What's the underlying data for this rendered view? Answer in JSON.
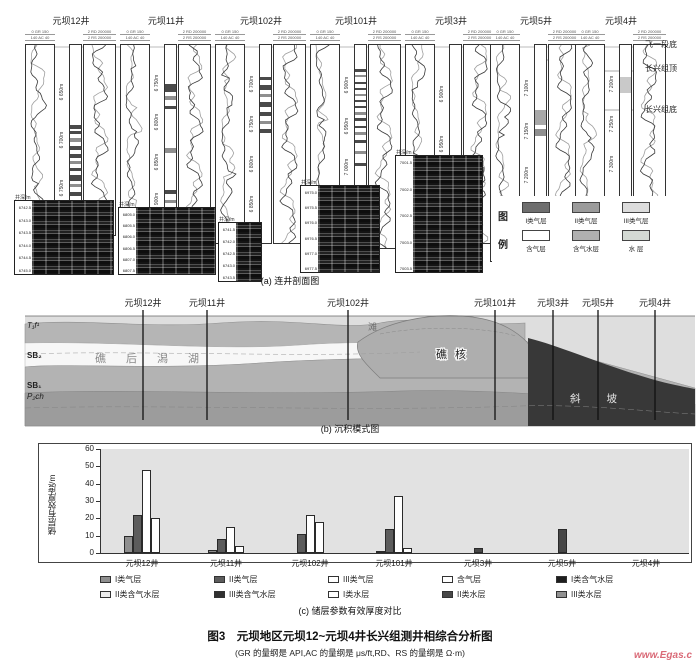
{
  "panel_a": {
    "caption": "(a) 连井剖面图",
    "depth_scale_label": "井深/m",
    "track1_header_line1": "0 GR 150",
    "track1_header_line2": "140 AC 40",
    "track2_header_line1": "2 RD 200000",
    "track2_header_line2": "2 RS 200000",
    "horizon_labels": [
      "飞一段底",
      "长兴组顶",
      "长兴组底"
    ],
    "legend_title_chars": [
      "图",
      "例"
    ],
    "legend_items": [
      {
        "label": "I类气层",
        "color": "#6e6e6e"
      },
      {
        "label": "II类气层",
        "color": "#9b9b9b"
      },
      {
        "label": "III类气层",
        "color": "#dcdcdc"
      },
      {
        "label": "含气层",
        "color": "#ffffff"
      },
      {
        "label": "含气水层",
        "color": "#b0b0b0"
      },
      {
        "label": "水 层",
        "color": "#d3d9d3"
      }
    ],
    "wells": [
      {
        "name": "元坝12井",
        "depth_labels": [
          "6 650m",
          "6 700m",
          "6 750m"
        ]
      },
      {
        "name": "元坝11井",
        "depth_labels": [
          "6 750m",
          "6 800m",
          "6 850m",
          "6 900m"
        ]
      },
      {
        "name": "元坝102井",
        "depth_labels": [
          "6 700m",
          "6 750m",
          "6 800m",
          "6 850m"
        ]
      },
      {
        "name": "元坝101井",
        "depth_labels": [
          "6 900m",
          "6 950m",
          "7 000m",
          "7 050m"
        ]
      },
      {
        "name": "元坝3井",
        "depth_labels": [
          "6 900m",
          "6 950m",
          "7 000m"
        ]
      },
      {
        "name": "元坝5井",
        "depth_labels": [
          "7 100m",
          "7 150m",
          "7 200m",
          "7 250m"
        ]
      },
      {
        "name": "元坝4井",
        "depth_labels": [
          "7 200m",
          "7 250m",
          "7 300m",
          "7 350m"
        ]
      }
    ],
    "fmi_inserts": [
      {
        "depth_labels": [
          "6742.5",
          "6743.0",
          "6743.5",
          "6744.0",
          "6744.5",
          "6745.0"
        ]
      },
      {
        "depth_labels": [
          "6805.0",
          "6805.5",
          "6806.0",
          "6806.5",
          "6807.0",
          "6807.5"
        ]
      },
      {
        "depth_labels": [
          "6741.5",
          "6742.0",
          "6742.5",
          "6743.0",
          "6743.5"
        ]
      },
      {
        "depth_labels": [
          "6975.0",
          "6975.5",
          "6976.0",
          "6976.5",
          "6977.0",
          "6977.5"
        ]
      },
      {
        "depth_labels": [
          "7001.5",
          "7002.0",
          "7002.5",
          "7003.0",
          "7003.5"
        ]
      }
    ]
  },
  "panel_b": {
    "caption": "(b) 沉积模式图",
    "well_labels": [
      "元坝12井",
      "元坝11井",
      "元坝102井",
      "元坝101井",
      "元坝3井",
      "元坝5井",
      "元坝4井"
    ],
    "strat_labels": [
      "T₁f¹",
      "SB₂",
      "SB₁",
      "P₂ch"
    ],
    "facies_lagoon": "礁后潟湖",
    "facies_shoal": "滩",
    "facies_reef_core": "礁核",
    "facies_slope": "斜坡"
  },
  "panel_c": {
    "caption": "(c) 储层参数有效厚度对比"
  },
  "chart_data": {
    "type": "bar",
    "title": "(c) 储层参数有效厚度对比",
    "xlabel": "",
    "ylabel": "储层有效厚度/m",
    "ylim": [
      0,
      60
    ],
    "yticks": [
      0,
      10,
      20,
      30,
      40,
      50,
      60
    ],
    "grid": false,
    "plot_bg": "#e2e2e2",
    "legend_position": "bottom",
    "categories": [
      "元坝12井",
      "元坝11井",
      "元坝102井",
      "元坝101井",
      "元坝3井",
      "元坝5井",
      "元坝4井"
    ],
    "series": [
      {
        "name": "I类气层",
        "color": "#8f8f8f",
        "values": [
          10,
          2,
          0,
          1,
          0,
          0,
          0
        ]
      },
      {
        "name": "II类气层",
        "color": "#5c5c5c",
        "values": [
          22,
          8,
          11,
          14,
          0,
          0,
          0
        ]
      },
      {
        "name": "III类气层",
        "color": "#ffffff",
        "values": [
          48,
          15,
          22,
          33,
          0,
          0,
          0
        ]
      },
      {
        "name": "含气层",
        "color": "#ffffff",
        "values": [
          20,
          4,
          18,
          3,
          0,
          0,
          0
        ]
      },
      {
        "name": "I类含气水层",
        "color": "#1e1e1e",
        "values": [
          0,
          0,
          0,
          0,
          0,
          0,
          0
        ]
      },
      {
        "name": "II类含气水层",
        "color": "#ededed",
        "values": [
          0,
          0,
          0,
          0,
          0,
          0,
          0
        ]
      },
      {
        "name": "III类含气水层",
        "color": "#303030",
        "values": [
          0,
          0,
          0,
          0,
          0,
          0,
          0
        ]
      },
      {
        "name": "I类水层",
        "color": "#ffffff",
        "values": [
          0,
          0,
          0,
          0,
          0,
          0,
          0
        ]
      },
      {
        "name": "II类水层",
        "color": "#474747",
        "values": [
          0,
          0,
          0,
          0,
          3,
          14,
          0
        ]
      },
      {
        "name": "III类水层",
        "color": "#919191",
        "values": [
          0,
          0,
          0,
          0,
          0,
          0,
          0
        ]
      }
    ]
  },
  "figure_caption": {
    "title": "图3　元坝地区元坝12~元坝4井长兴组测井相综合分析图",
    "subtitle": "(GR 的量纲是 API,AC 的量纲是 μs/ft,RD、RS 的量纲是 Ω·m)"
  },
  "watermark": "www.Egas.c"
}
